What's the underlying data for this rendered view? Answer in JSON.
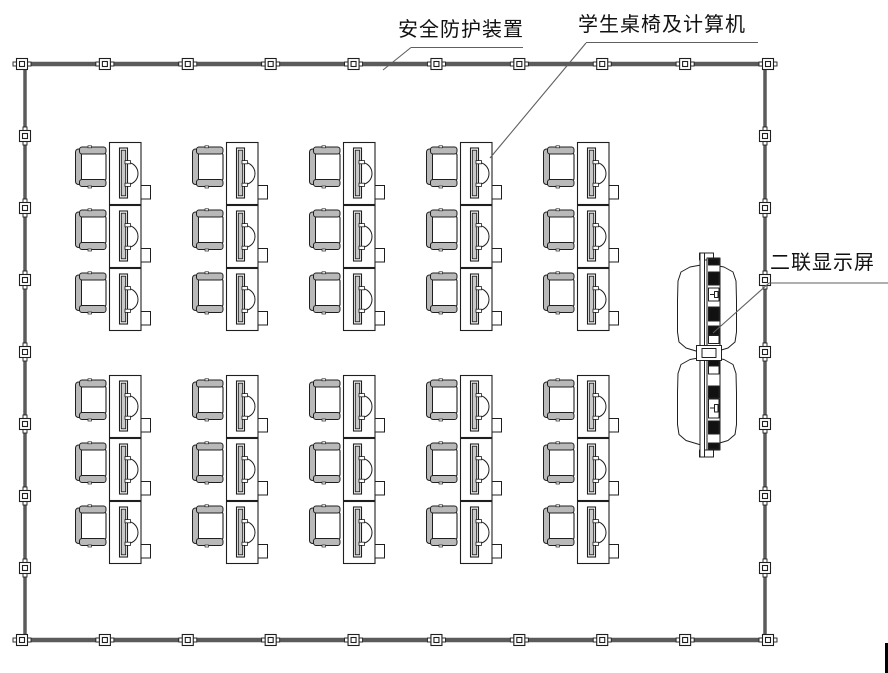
{
  "page": {
    "kind": "cad-floor-plan",
    "background": "#ffffff"
  },
  "labels": {
    "safety_device": "安全防护装置",
    "student_desks": "学生桌椅及计算机",
    "dual_display": "二联显示屏"
  },
  "colors": {
    "wall": "#5b5b5b",
    "line": "#1f1f1f",
    "leader": "#5f5f5f",
    "text": "#101010",
    "chair_fill": "#b9b9b9",
    "monitor_fill": "#c9c9c9"
  },
  "floorplan": {
    "room": {
      "x1": 22,
      "x2": 768,
      "top_y": 64,
      "bottom_y": 640,
      "left_x": 25,
      "right_x": 765
    },
    "wall_posts": {
      "top_bottom_count": 10,
      "left_right_interior": 7
    },
    "desk_grid": {
      "columns_x": [
        75,
        192,
        309,
        426,
        543
      ],
      "row_groups": [
        {
          "rows_y": [
            142,
            205,
            268
          ]
        },
        {
          "rows_y": [
            375,
            438,
            501
          ]
        }
      ],
      "unit": {
        "cell_width": 117,
        "cell_height": 63
      },
      "units_total": 30
    }
  }
}
